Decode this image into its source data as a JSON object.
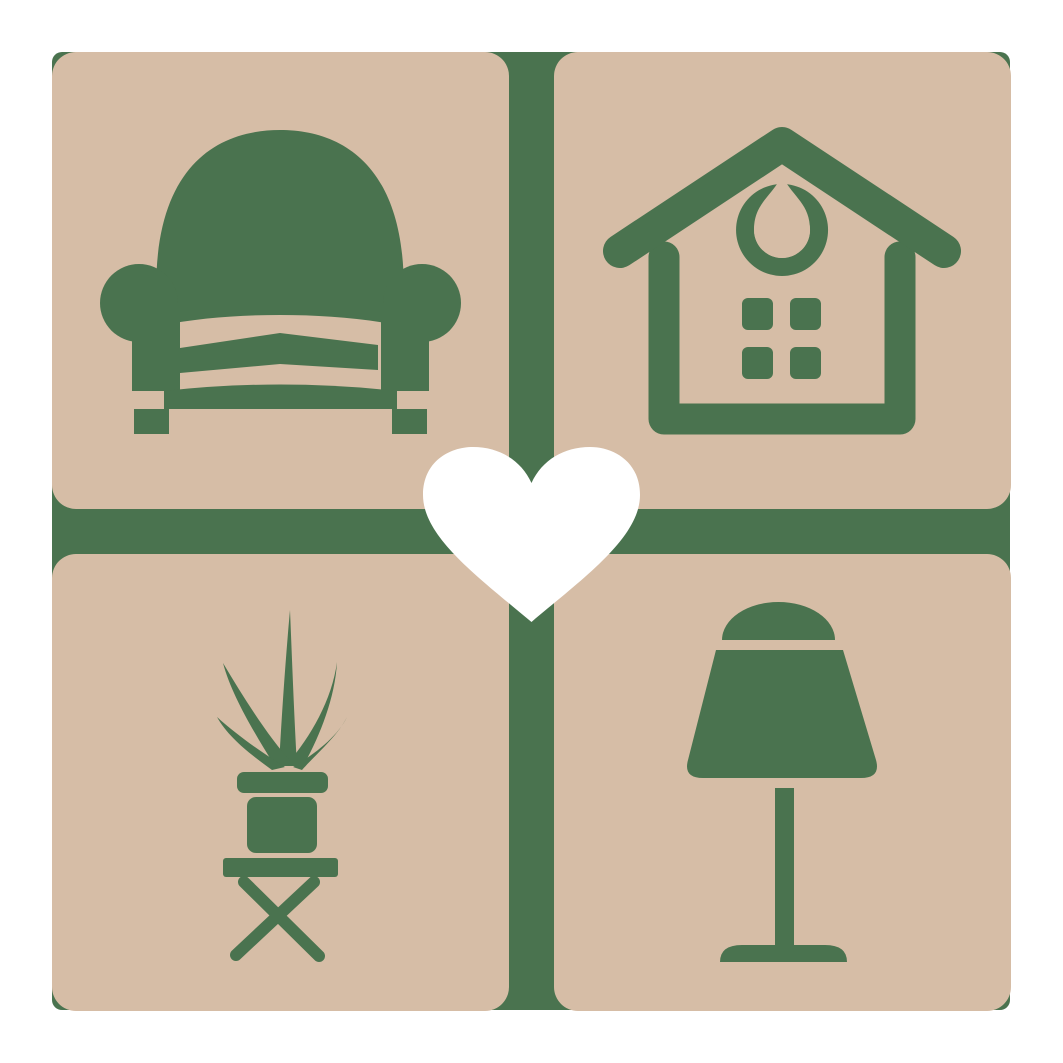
{
  "logo": {
    "name": "home-decor-heart-logo",
    "tiles": [
      {
        "position": "top-left",
        "icon": "armchair-icon"
      },
      {
        "position": "top-right",
        "icon": "house-icon"
      },
      {
        "position": "bottom-left",
        "icon": "potted-plant-icon"
      },
      {
        "position": "bottom-right",
        "icon": "table-lamp-icon"
      }
    ],
    "center": {
      "icon": "heart-icon"
    }
  },
  "colors": {
    "page_background": "#ffffff",
    "tile_tan": "#d6bda6",
    "icon_green": "#4a734f",
    "heart_white": "#ffffff"
  }
}
